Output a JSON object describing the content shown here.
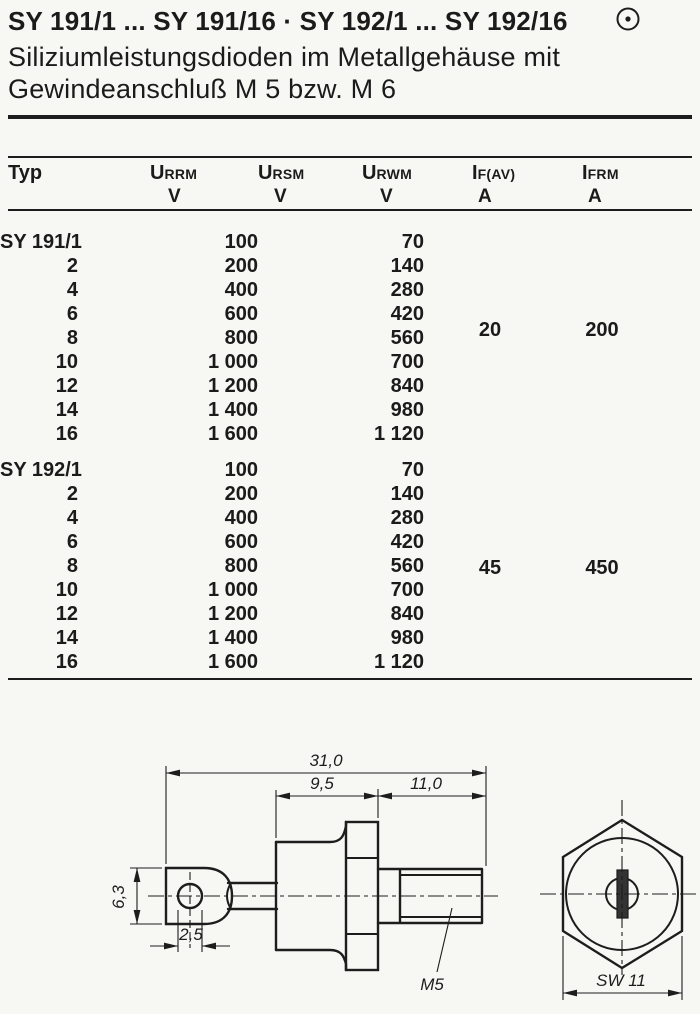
{
  "header": {
    "title": "SY 191/1 ... SY 191/16 · SY 192/1 ... SY 192/16",
    "subtitle_line1": "Siliziumleistungsdioden im Metallgehäuse mit",
    "subtitle_line2": "Gewindeanschluß M 5 bzw. M 6",
    "corner_symbol": "circled-dot-icon"
  },
  "table": {
    "columns": [
      {
        "base": "Typ",
        "sub": "",
        "unit": ""
      },
      {
        "base": "U",
        "sub": "RRM",
        "unit": "V"
      },
      {
        "base": "U",
        "sub": "RSM",
        "unit": "V"
      },
      {
        "base": "U",
        "sub": "RWM",
        "unit": "V"
      },
      {
        "base": "I",
        "sub": "F(AV)",
        "unit": "A"
      },
      {
        "base": "I",
        "sub": "FRM",
        "unit": "A"
      }
    ],
    "groups": [
      {
        "ifav": "20",
        "ifrm": "200",
        "rows": [
          {
            "typ": "SY 191/1",
            "urrm": "100",
            "urwm": "70"
          },
          {
            "typ": "2",
            "urrm": "200",
            "urwm": "140"
          },
          {
            "typ": "4",
            "urrm": "400",
            "urwm": "280"
          },
          {
            "typ": "6",
            "urrm": "600",
            "urwm": "420"
          },
          {
            "typ": "8",
            "urrm": "800",
            "urwm": "560"
          },
          {
            "typ": "10",
            "urrm": "1 000",
            "urwm": "700"
          },
          {
            "typ": "12",
            "urrm": "1 200",
            "urwm": "840"
          },
          {
            "typ": "14",
            "urrm": "1 400",
            "urwm": "980"
          },
          {
            "typ": "16",
            "urrm": "1 600",
            "urwm": "1 120"
          }
        ]
      },
      {
        "ifav": "45",
        "ifrm": "450",
        "rows": [
          {
            "typ": "SY 192/1",
            "urrm": "100",
            "urwm": "70"
          },
          {
            "typ": "2",
            "urrm": "200",
            "urwm": "140"
          },
          {
            "typ": "4",
            "urrm": "400",
            "urwm": "280"
          },
          {
            "typ": "6",
            "urrm": "600",
            "urwm": "420"
          },
          {
            "typ": "8",
            "urrm": "800",
            "urwm": "560"
          },
          {
            "typ": "10",
            "urrm": "1 000",
            "urwm": "700"
          },
          {
            "typ": "12",
            "urrm": "1 200",
            "urwm": "840"
          },
          {
            "typ": "14",
            "urrm": "1 400",
            "urwm": "980"
          },
          {
            "typ": "16",
            "urrm": "1 600",
            "urwm": "1 120"
          }
        ]
      }
    ]
  },
  "drawing": {
    "overall_length": "31,0",
    "body_length": "9,5",
    "stud_length": "11,0",
    "tab_height": "6,3",
    "hole_diameter": "2,5",
    "thread": "M5",
    "wrench_size": "SW 11"
  }
}
